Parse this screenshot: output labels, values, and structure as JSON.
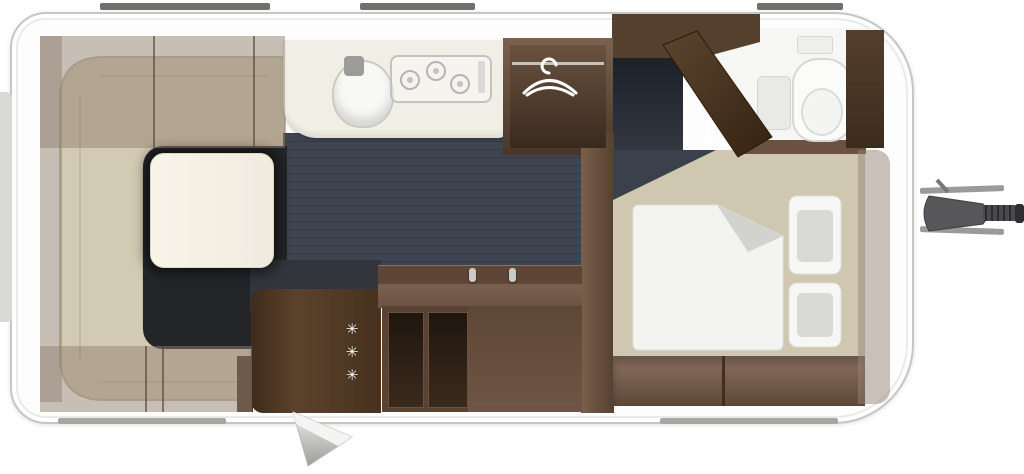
{
  "glyphs": {
    "freezer_stars": [
      "✳",
      "✳",
      "✳"
    ]
  },
  "icons": {
    "hanger": "hanger-icon",
    "door_handle": "door-handle-icon",
    "freezer_rating": "freezer-stars",
    "tow_hitch": "tow-hitch"
  },
  "rooms": [
    "lounge-dinette",
    "kitchen",
    "wardrobe",
    "entrance",
    "bathroom",
    "bedroom"
  ],
  "furniture": {
    "lounge": [
      "u-shaped-sofa",
      "dinette-table",
      "overhead-lockers"
    ],
    "kitchen": [
      "counter",
      "sink",
      "three-burner-hob"
    ],
    "wardrobe": [
      "clothes-rail",
      "hanger"
    ],
    "bathroom": [
      "toilet",
      "bench",
      "roof-vent",
      "cabinet"
    ],
    "bedroom": [
      "double-bed",
      "duvet",
      "pillow",
      "pillow",
      "under-bed-drawers"
    ],
    "entrance": [
      "fridge",
      "sideboard",
      "open-shelves",
      "entry-step"
    ]
  },
  "colors": {
    "body_white": "#fdfdfd",
    "wall_outline": "#c6c6c4",
    "wood_dark": "#46321f",
    "wood_medium": "#6b5140",
    "wood_light": "#7c6252",
    "sofa_beige": "#d3cab4",
    "bed_beige": "#cfc7b0",
    "floor_dark": "#232528",
    "floor_walkway": "#3f4550",
    "counter_white": "#f1eee6",
    "overhead_taupe": "rgba(146,128,112,0.5)",
    "duvet_white": "#f3f3f1",
    "metal_gray": "#9a9a97"
  }
}
